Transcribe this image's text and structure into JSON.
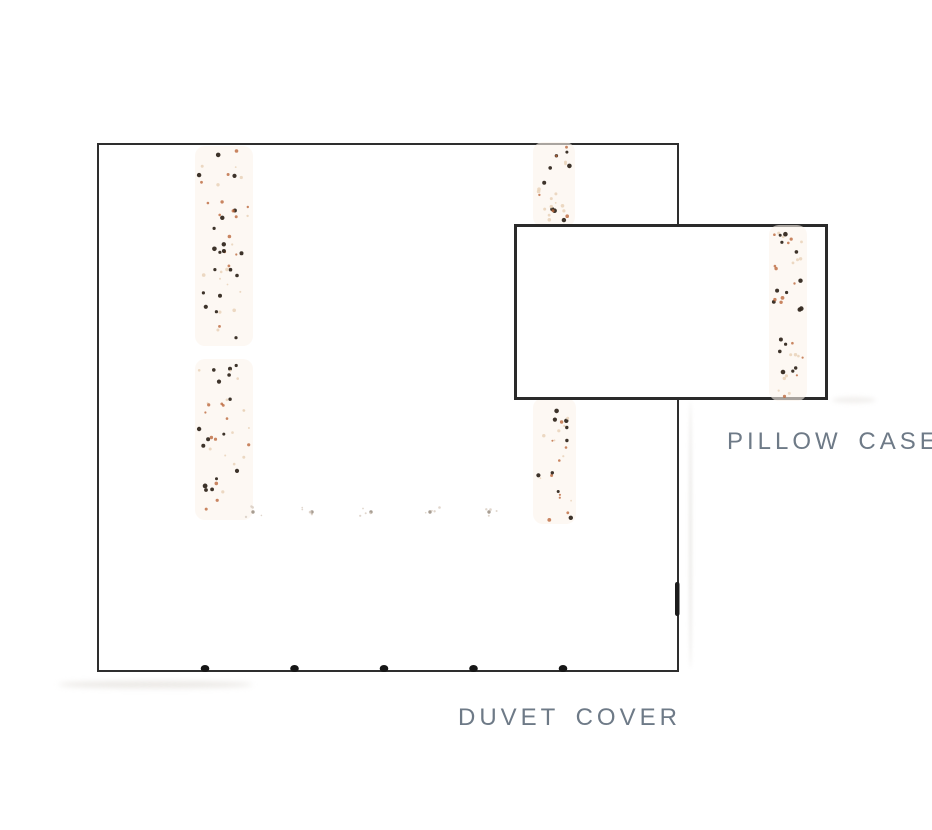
{
  "diagram": {
    "duvet_label": "DUVET COVER",
    "pillow_label": "PILLOW CASE",
    "label_color": "#6e7a87",
    "duvet_outline_color": "#2e2e2e",
    "pillow_outline_color": "#2a2a2a",
    "closure_button_count": 5,
    "speckle_colors": {
      "dark_brown": "#33281f",
      "rust_orange": "#bc683c",
      "pale_tan": "#e9d2b8",
      "faint_gray": "#8a7c6e",
      "faint_pale": "#d8ccc0"
    },
    "band_tint": "#fbf3eb",
    "button_color": "#161616",
    "edge_mark_color": "#1c1c1c"
  }
}
